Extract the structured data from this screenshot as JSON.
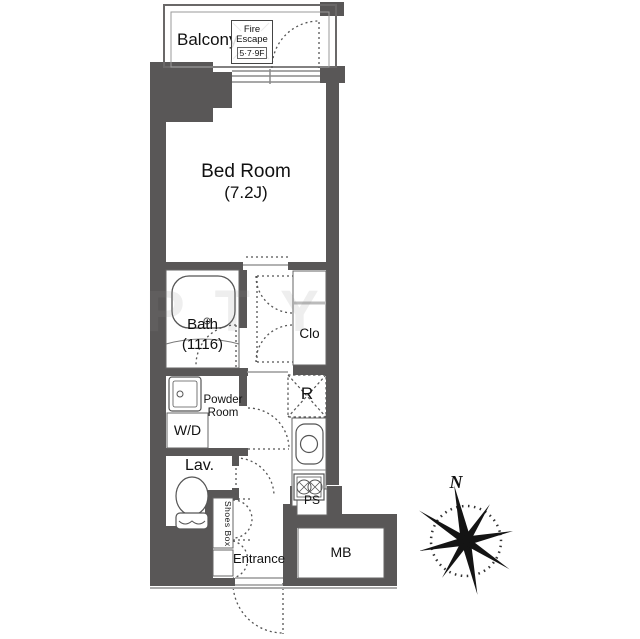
{
  "colors": {
    "wall": "#595757",
    "line": "#555555",
    "lightline": "#999999",
    "text": "#111111",
    "bg": "#ffffff"
  },
  "labels": {
    "balcony": "Balcony",
    "fire_escape_line1": "Fire",
    "fire_escape_line2": "Escape",
    "fire_escape_floors": "5·7·9F",
    "bed_room": "Bed Room",
    "bed_room_size": "(7.2J)",
    "bath": "Bath",
    "bath_size": "(1116)",
    "closet": "Clo",
    "powder_room_line1": "Powder",
    "powder_room_line2": "Room",
    "washer_dryer": "W/D",
    "refrigerator": "R",
    "lavatory": "Lav.",
    "shoes_box": "Shoes Box",
    "entrance": "Entrance",
    "pipe_shaft": "PS",
    "meter_box": "MB",
    "compass_north": "N",
    "watermark": "PTY"
  }
}
